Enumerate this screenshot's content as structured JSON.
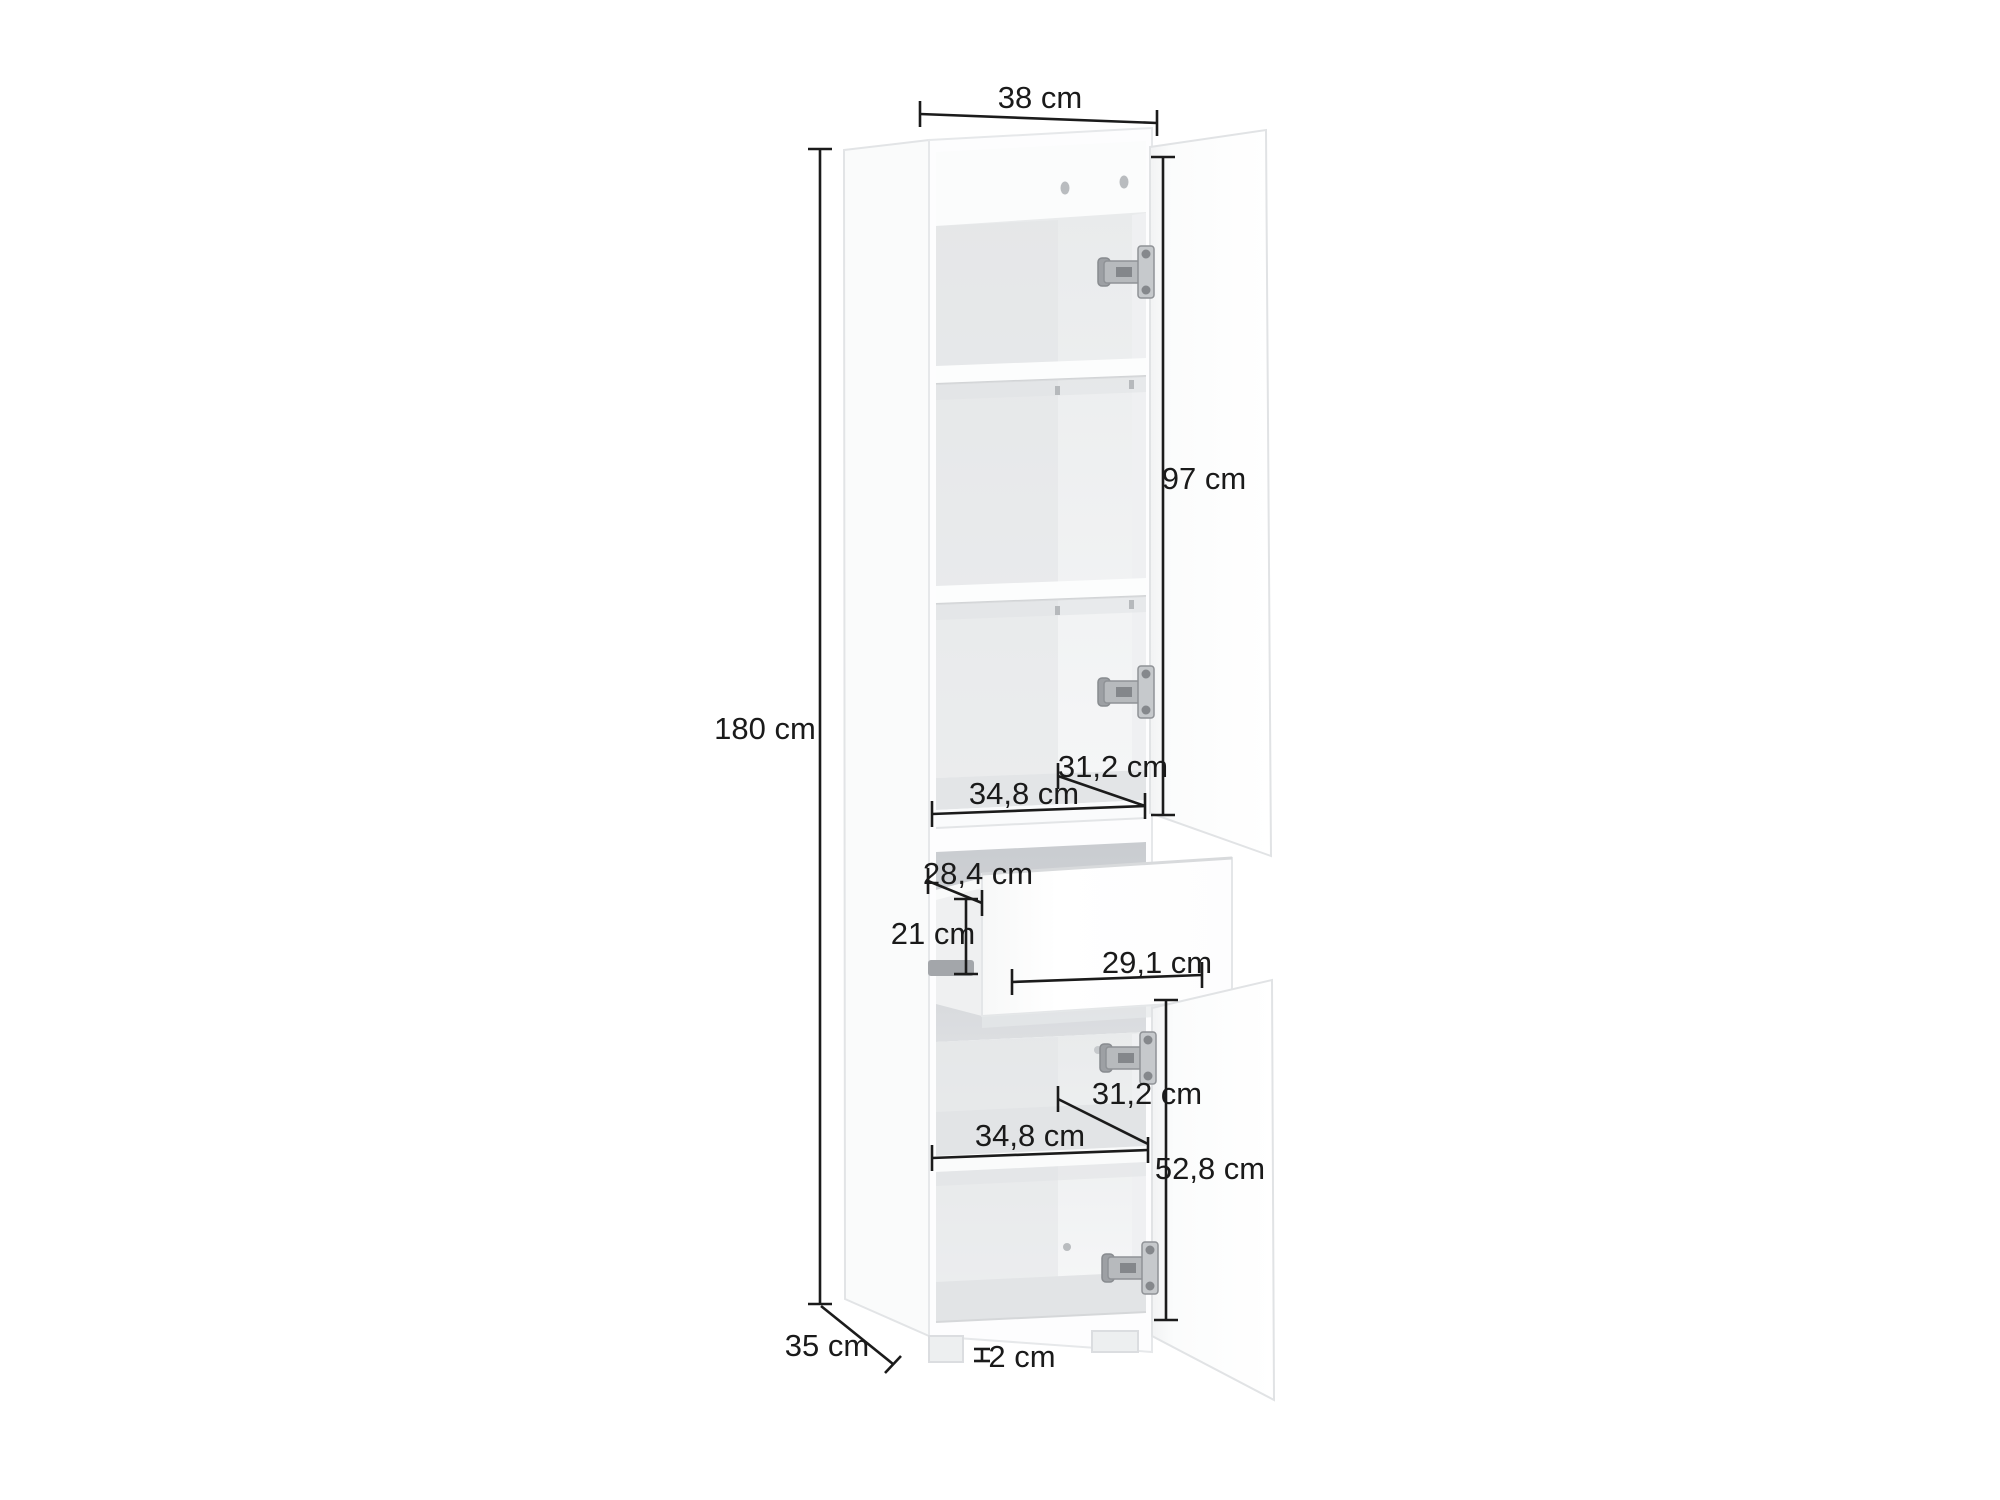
{
  "page": {
    "background": "#ffffff"
  },
  "diagram": {
    "title": "Tall cabinet dimension diagram",
    "subject": "tall storage cabinet with two open doors, three upper shelves, pulled-out drawer and lower shelf",
    "unit": "cm",
    "labels": {
      "width_top": "38 cm",
      "total_height": "180 cm",
      "upper_door_height": "97 cm",
      "upper_interior_depth": "31,2 cm",
      "upper_interior_width": "34,8 cm",
      "drawer_depth": "28,4 cm",
      "drawer_height": "21 cm",
      "drawer_width": "29,1 cm",
      "lower_interior_depth": "31,2 cm",
      "lower_interior_width": "34,8 cm",
      "lower_door_height": "52,8 cm",
      "cabinet_depth": "35 cm",
      "foot_height": "2 cm"
    },
    "colors": {
      "dimension_line": "#1b1b1b",
      "text": "#1a1a1a",
      "carcass_white": "#fdfdfe",
      "interior_shade": "#e7e9eb",
      "shelf_shadow": "#e0e2e4",
      "hinge_metal": "#b7babd",
      "hinge_dark": "#85888c"
    }
  }
}
